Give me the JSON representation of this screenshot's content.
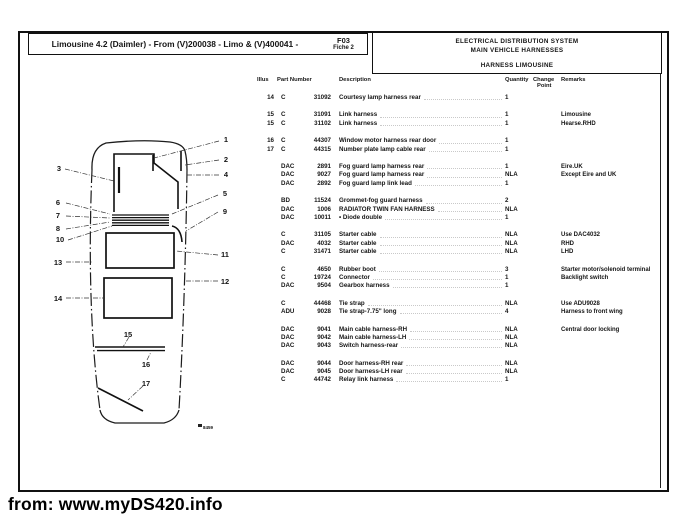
{
  "page": {
    "title": "Limousine 4.2 (Daimler) - From (V)200038 - Limo & (V)400041 -",
    "fiche": {
      "line1": "F03",
      "line2": "Fiche 2"
    },
    "system_header": {
      "line1": "ELECTRICAL DISTRIBUTION SYSTEM",
      "line2": "MAIN VEHICLE HARNESSES"
    },
    "section_header": "HARNESS LIMOUSINE",
    "footer_source": "from: www.myDS420.info"
  },
  "table": {
    "headers": {
      "illus": "Illus",
      "part_number": "Part Number",
      "description": "Description",
      "quantity": "Quantity",
      "change_line1": "Change",
      "change_line2": "Point",
      "remarks": "Remarks"
    },
    "rows": [
      {
        "illus": "14",
        "prefix": "C",
        "number": "31092",
        "desc": "Courtesy lamp harness rear",
        "qty": "1",
        "remarks": ""
      },
      {
        "spacer": true
      },
      {
        "illus": "15",
        "prefix": "C",
        "number": "31091",
        "desc": "Link harness",
        "qty": "1",
        "remarks": "Limousine"
      },
      {
        "illus": "15",
        "prefix": "C",
        "number": "31102",
        "desc": "Link harness",
        "qty": "1",
        "remarks": "Hearse.RHD"
      },
      {
        "spacer": true
      },
      {
        "illus": "16",
        "prefix": "C",
        "number": "44307",
        "desc": "Window motor harness rear door",
        "qty": "1",
        "remarks": ""
      },
      {
        "illus": "17",
        "prefix": "C",
        "number": "44315",
        "desc": "Number plate lamp cable rear",
        "qty": "1",
        "remarks": ""
      },
      {
        "spacer": true
      },
      {
        "illus": "",
        "prefix": "DAC",
        "number": "2891",
        "desc": "Fog guard lamp harness rear",
        "qty": "1",
        "remarks": "Eire.UK"
      },
      {
        "illus": "",
        "prefix": "DAC",
        "number": "9027",
        "desc": "Fog guard lamp harness rear",
        "qty": "NLA",
        "remarks": "Except Eire and UK"
      },
      {
        "illus": "",
        "prefix": "DAC",
        "number": "2892",
        "desc": "Fog guard lamp link lead",
        "qty": "1",
        "remarks": ""
      },
      {
        "spacer": true
      },
      {
        "illus": "",
        "prefix": "BD",
        "number": "11524",
        "desc": "Grommet-fog guard harness",
        "qty": "2",
        "remarks": ""
      },
      {
        "illus": "",
        "prefix": "DAC",
        "number": "1006",
        "desc": "RADIATOR TWIN FAN HARNESS",
        "qty": "NLA",
        "remarks": ""
      },
      {
        "illus": "",
        "prefix": "DAC",
        "number": "10011",
        "desc": "• Diode double",
        "qty": "1",
        "remarks": ""
      },
      {
        "spacer": true
      },
      {
        "illus": "",
        "prefix": "C",
        "number": "31105",
        "desc": "Starter cable",
        "qty": "NLA",
        "remarks": "Use DAC4032"
      },
      {
        "illus": "",
        "prefix": "DAC",
        "number": "4032",
        "desc": "Starter cable",
        "qty": "NLA",
        "remarks": "RHD"
      },
      {
        "illus": "",
        "prefix": "C",
        "number": "31471",
        "desc": "Starter cable",
        "qty": "NLA",
        "remarks": "LHD"
      },
      {
        "spacer": true
      },
      {
        "illus": "",
        "prefix": "C",
        "number": "4650",
        "desc": "Rubber boot",
        "qty": "3",
        "remarks": "Starter motor/solenoid terminal"
      },
      {
        "illus": "",
        "prefix": "C",
        "number": "19724",
        "desc": "Connector",
        "qty": "1",
        "remarks": "Backlight switch"
      },
      {
        "illus": "",
        "prefix": "DAC",
        "number": "9504",
        "desc": "Gearbox harness",
        "qty": "1",
        "remarks": ""
      },
      {
        "spacer": true
      },
      {
        "illus": "",
        "prefix": "C",
        "number": "44468",
        "desc": "Tie strap",
        "qty": "NLA",
        "remarks": "Use ADU9028"
      },
      {
        "illus": "",
        "prefix": "ADU",
        "number": "9028",
        "desc": "Tie strap-7.75\" long",
        "qty": "4",
        "remarks": "Harness to front wing"
      },
      {
        "spacer": true
      },
      {
        "illus": "",
        "prefix": "DAC",
        "number": "9041",
        "desc": "Main cable harness-RH",
        "qty": "NLA",
        "remarks": "Central door locking"
      },
      {
        "illus": "",
        "prefix": "DAC",
        "number": "9042",
        "desc": "Main cable harness-LH",
        "qty": "NLA",
        "remarks": ""
      },
      {
        "illus": "",
        "prefix": "DAC",
        "number": "9043",
        "desc": "Switch harness-rear",
        "qty": "NLA",
        "remarks": ""
      },
      {
        "spacer": true
      },
      {
        "illus": "",
        "prefix": "DAC",
        "number": "9044",
        "desc": "Door harness-RH rear",
        "qty": "NLA",
        "remarks": ""
      },
      {
        "illus": "",
        "prefix": "DAC",
        "number": "9045",
        "desc": "Door harness-LH rear",
        "qty": "NLA",
        "remarks": ""
      },
      {
        "illus": "",
        "prefix": "C",
        "number": "44742",
        "desc": "Relay link harness",
        "qty": "1",
        "remarks": ""
      }
    ]
  },
  "diagram": {
    "callouts": [
      "1",
      "2",
      "3",
      "4",
      "5",
      "6",
      "7",
      "8",
      "9",
      "10",
      "11",
      "12",
      "13",
      "14",
      "15",
      "16",
      "17"
    ],
    "plate_code": "8459"
  }
}
